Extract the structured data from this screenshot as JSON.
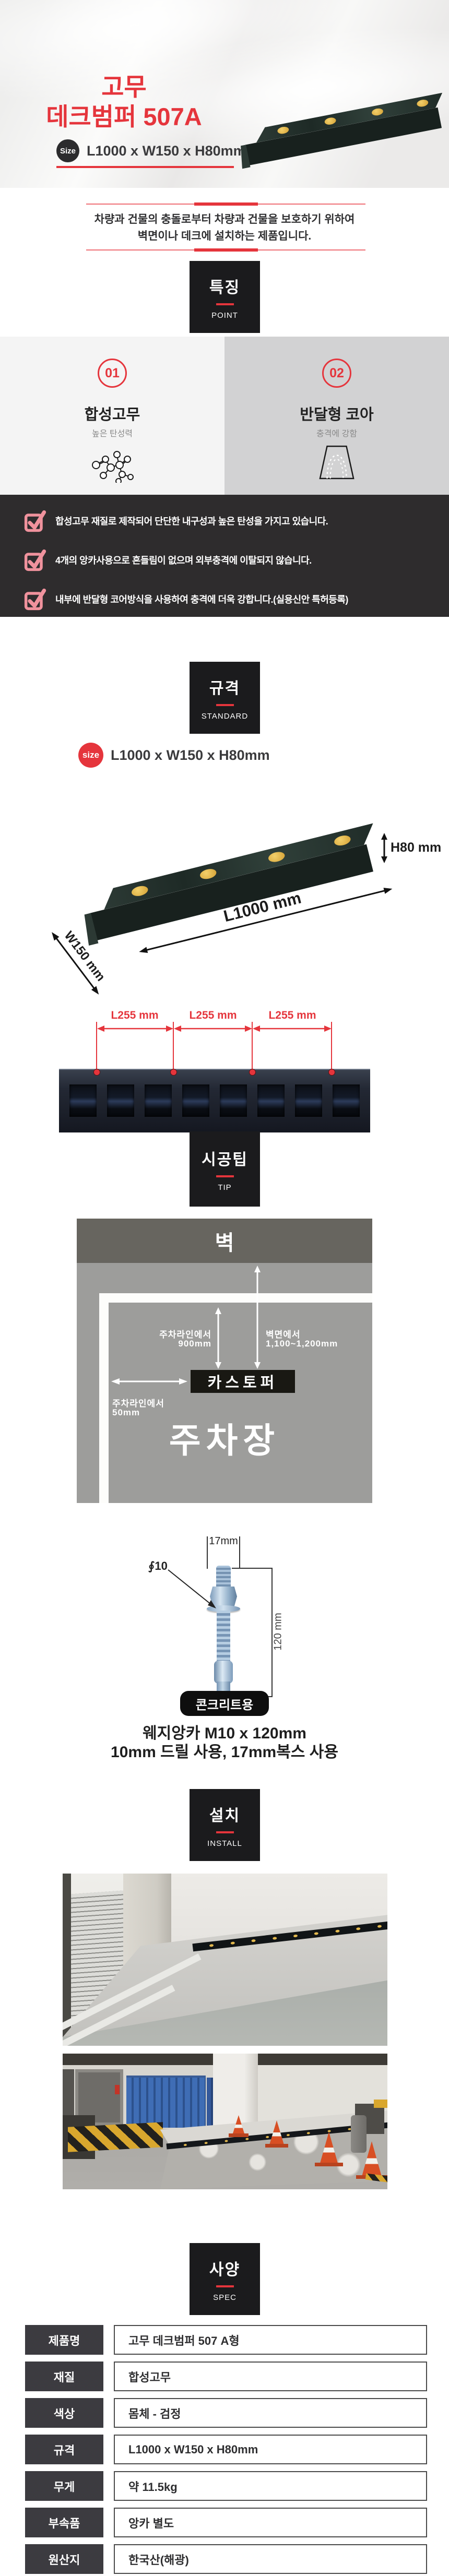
{
  "hero": {
    "title_line1": "고무",
    "title_line2": "데크범퍼 507A",
    "size_badge_label": "Size",
    "size_value": "L1000 x W150 x H80mm"
  },
  "intro": {
    "line1": "차량과 건물의 충돌로부터 차량과 건물을 보호하기 위하여",
    "line2": "벽면이나 데크에 설치하는 제품입니다."
  },
  "features": {
    "header": {
      "title": "특징",
      "subtitle": "POINT"
    },
    "points": [
      {
        "number": "01",
        "title": "합성고무",
        "subtitle": "높은 탄성력",
        "icon": "molecule-icon"
      },
      {
        "number": "02",
        "title": "반달형 코아",
        "subtitle": "충격에 강함",
        "icon": "half-core-icon"
      }
    ]
  },
  "checklist": {
    "items": [
      "합성고무 재질로 제작되어 단단한 내구성과 높은 탄성을 가지고 있습니다.",
      "4개의 앙카사용으로 흔들림이 없으며 외부충격에 이탈되지 않습니다.",
      "내부에 반달형 코어방식을 사용하여 충격에 더욱 강합니다.(실용신안 특허등록)"
    ]
  },
  "standard": {
    "header": {
      "title": "규격",
      "subtitle": "STANDARD"
    },
    "size_badge_label": "size",
    "size_value": "L1000 x W150 x H80mm",
    "dim_height": "H80 mm",
    "dim_length": "L1000 mm",
    "dim_width": "W150 mm",
    "spacing_labels": [
      "L255 mm",
      "L255 mm",
      "L255 mm"
    ]
  },
  "tip": {
    "header": {
      "title": "시공팁",
      "subtitle": "TIP"
    },
    "diagram": {
      "wall_label": "벽",
      "parking_line_top_label": "주차라인에서",
      "parking_line_top_value": "900mm",
      "wall_dist_label": "벽면에서",
      "wall_dist_value": "1,100~1,200mm",
      "stopper_label": "카스토퍼",
      "parking_line_left_label": "주차라인에서",
      "parking_line_left_value": "50mm",
      "parking_lot_label": "주차장"
    },
    "anchor": {
      "width_label": "17mm",
      "diameter_label": "∮10",
      "length_label": "120 mm",
      "badge": "콘크리트용",
      "caption_line1": "웨지앙카 M10 x 120mm",
      "caption_line2": "10mm 드릴 사용, 17mm복스 사용"
    }
  },
  "install": {
    "header": {
      "title": "설치",
      "subtitle": "INSTALL"
    }
  },
  "spec": {
    "header": {
      "title": "사양",
      "subtitle": "SPEC"
    },
    "rows": [
      {
        "label": "제품명",
        "value": "고무 데크범퍼 507 A형"
      },
      {
        "label": "재질",
        "value": "합성고무"
      },
      {
        "label": "색상",
        "value": "몸체 - 검정"
      },
      {
        "label": "규격",
        "value": "L1000 x W150 x H80mm"
      },
      {
        "label": "무게",
        "value": "약 11.5kg"
      },
      {
        "label": "부속품",
        "value": "앙카 별도"
      },
      {
        "label": "원산지",
        "value": "한국산(해광)"
      }
    ]
  },
  "colors": {
    "accent_red": "#e5353c",
    "header_box_bg": "#1b1b1d",
    "checklist_bg": "#2e2c2d",
    "check_icon_pink": "#f0929d",
    "point_left_bg": "#f4f4f4",
    "point_right_bg": "#d2d2d3",
    "bumper_yellow": "#e8c25a"
  }
}
